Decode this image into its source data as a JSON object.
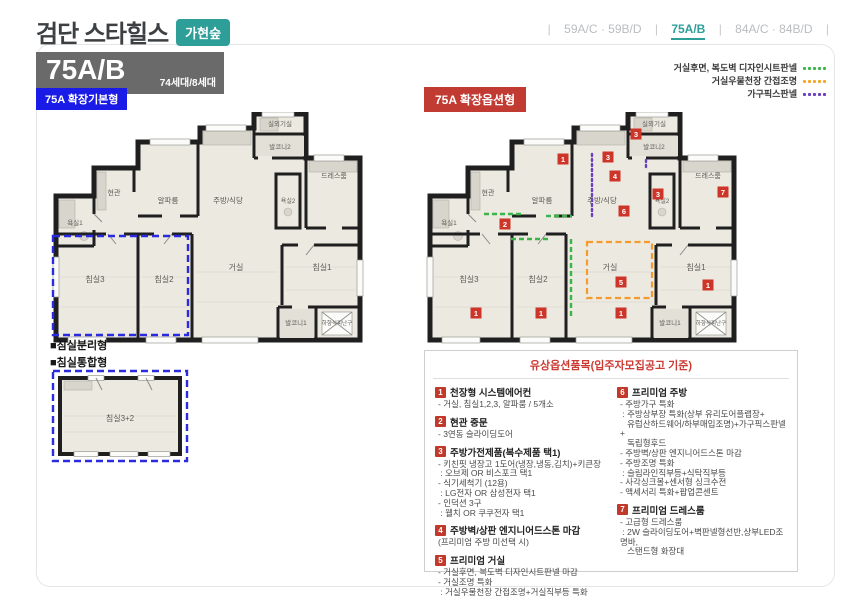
{
  "header": {
    "title": "검단 스타힐스",
    "location_badge": "가현숲",
    "type_code": "75A/B",
    "unit_count": "74세대/8세대",
    "nav": {
      "separator": "|",
      "tabs": [
        {
          "label": "59A/C · 59B/D",
          "active": false
        },
        {
          "label": "75A/B",
          "active": true
        },
        {
          "label": "84A/C · 84B/D",
          "active": false
        }
      ]
    }
  },
  "plans": {
    "left_badge": "75A 확장기본형",
    "right_badge": "75A 확장옵션형",
    "caption_separated": "■침실분리형",
    "caption_combined": "■침실통합형",
    "combined_room_label": "침실3+2",
    "rooms": {
      "outdoor_unit": "실외기실",
      "balcony2": "발코니2",
      "dress_room": "드레스룸",
      "entrance": "현관",
      "alpha_room": "알파룸",
      "kitchen_dining": "주방/식당",
      "bath1": "욕실1",
      "bath2": "욕실2",
      "bedroom3": "침실3",
      "bedroom2": "침실2",
      "living": "거실",
      "bedroom1": "침실1",
      "balcony1": "발코니1",
      "escape_hatch": "하향식피난구"
    },
    "legend": [
      {
        "label": "거실후면, 복도벽 디자인시트판넬",
        "color": "#3bb54a"
      },
      {
        "label": "거실우물천장 간접조명",
        "color": "#f5a623"
      },
      {
        "label": "가구픽스판넬",
        "color": "#6a3fc3"
      }
    ],
    "markers": [
      {
        "num": "1"
      },
      {
        "num": "3"
      },
      {
        "num": "3"
      },
      {
        "num": "4"
      },
      {
        "num": "3"
      },
      {
        "num": "7"
      },
      {
        "num": "2"
      },
      {
        "num": "6"
      },
      {
        "num": "5"
      },
      {
        "num": "1"
      },
      {
        "num": "1"
      },
      {
        "num": "1"
      },
      {
        "num": "1"
      }
    ]
  },
  "options": {
    "title": "유상옵션품목(입주자모집공고 기준)",
    "items": [
      {
        "num": "1",
        "title": "천장형 시스템에어컨",
        "lines": [
          "- 거실, 침실1,2,3, 알파룸 / 5개소"
        ]
      },
      {
        "num": "2",
        "title": "현관 중문",
        "lines": [
          "- 3연동 슬라이딩도어"
        ]
      },
      {
        "num": "3",
        "title": "주방가전제품(복수제품 택1)",
        "lines": [
          "- 키친핏 냉장고 1도어(냉장,냉동,김치)+키큰장",
          " : 오브제 OR 비스포크 택1",
          "- 식기세척기 (12용)",
          " : LG전자 OR 삼성전자 택1",
          "- 인덕션 3구",
          " : 웰치 OR 쿠쿠전자 택1"
        ]
      },
      {
        "num": "4",
        "title": "주방벽/상판 엔지니어드스톤 마감",
        "lines": [
          "(프리미엄 주방 미선택 시)"
        ]
      },
      {
        "num": "5",
        "title": "프리미엄 거실",
        "lines": [
          "- 거실후면, 복도벽 디자인시트판넬 마감",
          "- 거실조명 특화",
          " : 거실우물천장 간접조명+거실직부등 특화"
        ]
      },
      {
        "num": "6",
        "title": "프리미엄 주방",
        "lines": [
          "- 주방가구 특화",
          " : 주방상부장 특화(상부 유리도어플랩장+",
          "   유럽산하드웨어/하부매입조명)+가구픽스판넬+",
          "   독립형후드",
          "- 주방벽/상판 엔지니어드스톤 마감",
          "- 주방조명 특화",
          " : 슬림라인직부등+식탁직부등",
          "- 사각싱크볼+센서형 싱크수전",
          "- 액세서리 특화+팝업콘센트"
        ]
      },
      {
        "num": "7",
        "title": "프리미엄 드레스룸",
        "lines": [
          "- 고급형 드레스룸",
          " : 2W 슬라이딩도어+벽판넬형선반,상부LED조명바,",
          "   스탠드형 화장대"
        ]
      }
    ]
  },
  "colors": {
    "teal": "#2e9e99",
    "blue_badge": "#1b1be8",
    "red_badge": "#c23b32",
    "marker_red": "#ce3529",
    "option_number_red": "#c0392b",
    "wall": "#1f1f1f",
    "floor": "#ece9e1",
    "legend_green": "#3bb54a",
    "legend_orange": "#f5a623",
    "legend_purple": "#6a3fc3"
  }
}
